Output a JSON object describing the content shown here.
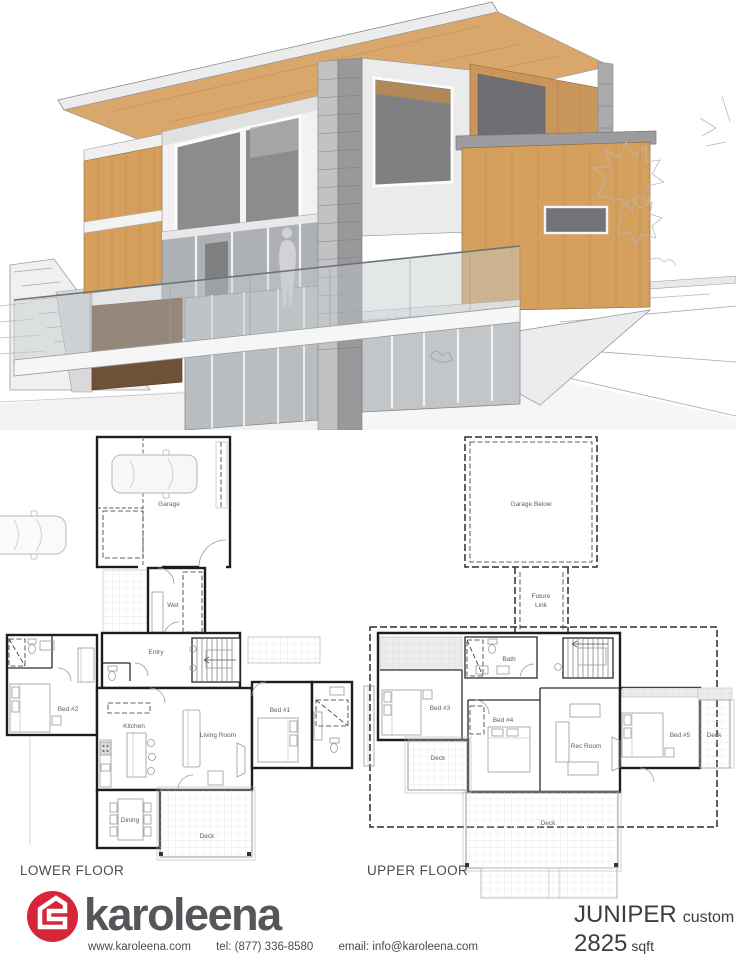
{
  "render": {
    "description": "3d-house-rendering",
    "palette": {
      "wood": "#d9a76c",
      "wood_box": "#d5a05e",
      "wood_dark_panel": "#6f5138",
      "wall_gray": "#9b9b9d",
      "white_wall": "#f2f2f2",
      "glass_dark": "#85878a"
    }
  },
  "floor_plans": {
    "lower": {
      "title": "LOWER FLOOR",
      "rooms": {
        "garage": "Garage",
        "wet": "Wet",
        "entry": "Entry",
        "bed2": "Bed #2",
        "kitchen": "Kitchen",
        "living_room": "Living Room",
        "bed1": "Bed #1",
        "dining": "Dining",
        "deck": "Deck"
      }
    },
    "upper": {
      "title": "UPPER FLOOR",
      "rooms": {
        "garage_below": "Garage Below",
        "future_line1": "Future",
        "future_line2": "Link",
        "bath": "Bath",
        "bed3": "Bed #3",
        "bed4": "Bed #4",
        "rec_room": "Rec Room",
        "bed5": "Bed #5",
        "deck_left": "Deck",
        "deck_right": "Deck",
        "deck_bottom": "Deck"
      }
    }
  },
  "footer": {
    "brand": "karoleena",
    "brand_color": "#d7263a",
    "website": "www.karoleena.com",
    "phone": "tel: (877) 336-8580",
    "email": "email: info@karoleena.com",
    "model": {
      "name": "JUNIPER",
      "variant": "custom",
      "area": "2825",
      "unit": "sqft"
    }
  }
}
